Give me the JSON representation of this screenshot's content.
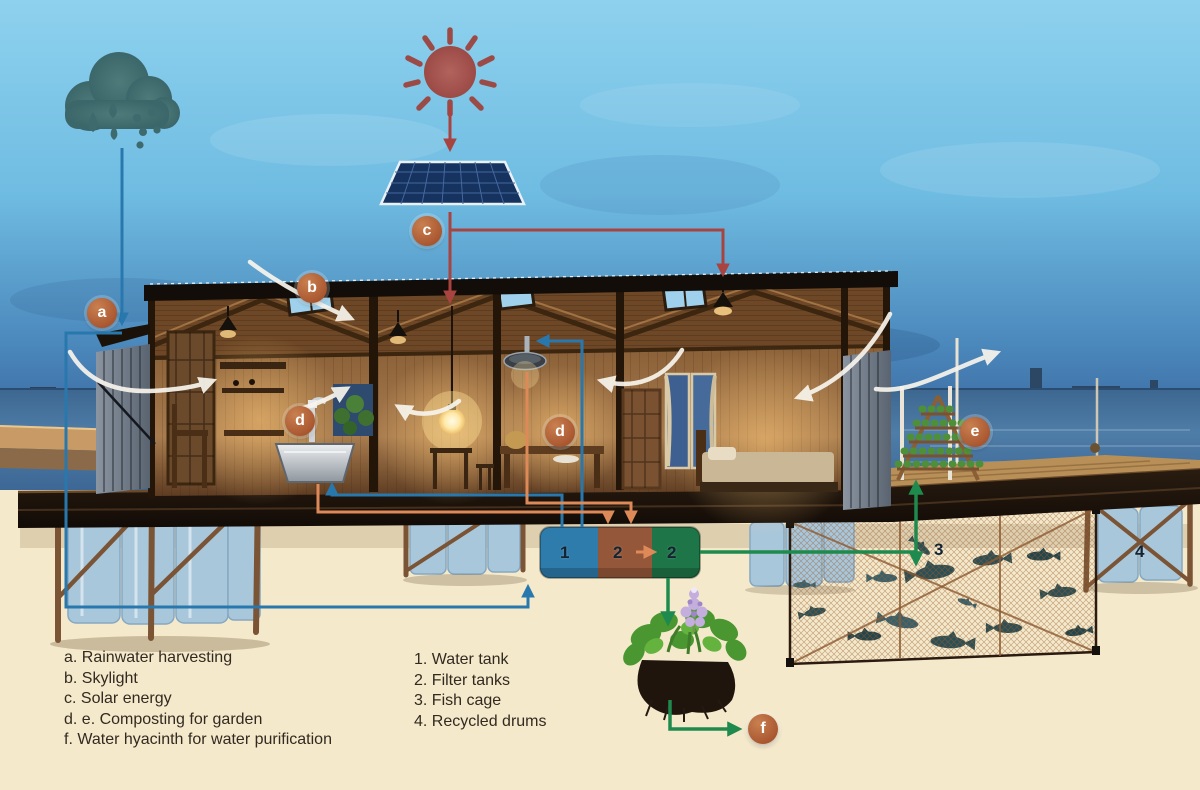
{
  "diagram": {
    "markers": [
      {
        "letter": "a",
        "meaning": "Rainwater harvesting"
      },
      {
        "letter": "b",
        "meaning": "Skylight"
      },
      {
        "letter": "c",
        "meaning": "Solar energy"
      },
      {
        "letter": "d",
        "meaning": "Composting for garden (sink)"
      },
      {
        "letter": "d",
        "meaning": "Composting for garden (shower)"
      },
      {
        "letter": "e",
        "meaning": "Composting for garden (vegetable rack)"
      },
      {
        "letter": "f",
        "meaning": "Water hyacinth for water purification"
      }
    ],
    "tank_numbers": [
      {
        "value": "1",
        "meaning": "Water tank"
      },
      {
        "value": "2",
        "meaning": "Filter tank"
      },
      {
        "value": "2",
        "meaning": "Filter tank"
      }
    ],
    "site_numbers": [
      {
        "value": "3",
        "meaning": "Fish cage"
      },
      {
        "value": "4",
        "meaning": "Recycled drums"
      }
    ],
    "icons": [
      "rain-cloud-icon",
      "sun-icon",
      "solar-panel-icon",
      "skylight-icon",
      "light-bulb-icon",
      "pendant-lamp-icon",
      "shower-icon",
      "sink-icon",
      "garden-rack-icon",
      "water-hyacinth-icon",
      "fish-icon",
      "recycled-drum-icon",
      "boat-icon",
      "airflow-arrow-icon"
    ],
    "colors": {
      "rain_water_line": "#2878ad",
      "solar_line": "#a84340",
      "grey_water_line": "#de8a58",
      "purified_water_line": "#1f8a4d",
      "marker_circle": "#b06032",
      "tank_blue": "#2e7cab",
      "tank_brown": "#95573a",
      "tank_green": "#1e7547"
    }
  },
  "legend_systems": {
    "items": [
      "a. Rainwater harvesting",
      "b. Skylight",
      "c. Solar energy",
      "d. e. Composting for garden",
      "f. Water hyacinth for water purification"
    ]
  },
  "legend_components": {
    "items": [
      "1. Water tank",
      "2. Filter tanks",
      "3. Fish cage",
      "4. Recycled drums"
    ]
  }
}
